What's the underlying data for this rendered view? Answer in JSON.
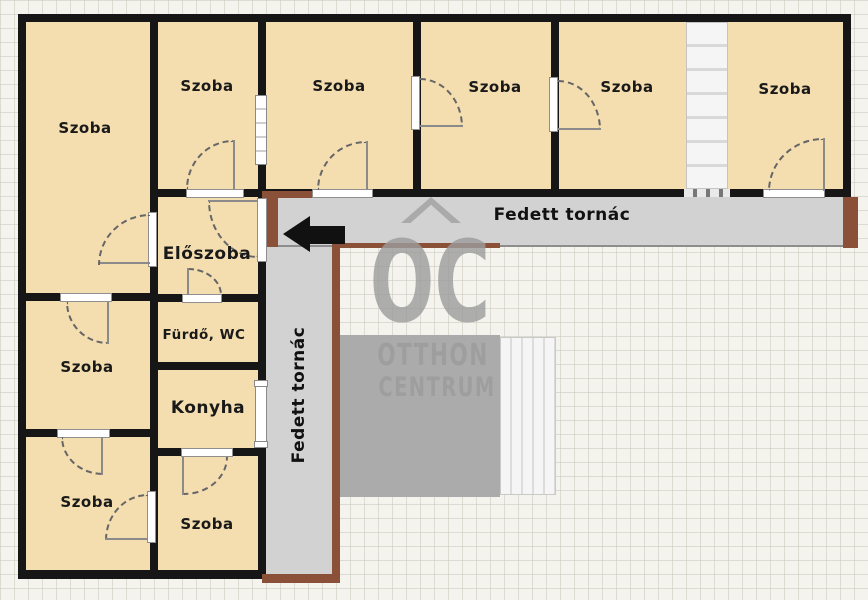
{
  "plan": {
    "rooms": [
      {
        "id": "szoba-top-left",
        "label": "Szoba"
      },
      {
        "id": "szoba-top-2",
        "label": "Szoba"
      },
      {
        "id": "szoba-top-3",
        "label": "Szoba"
      },
      {
        "id": "szoba-top-4",
        "label": "Szoba"
      },
      {
        "id": "szoba-top-5",
        "label": "Szoba"
      },
      {
        "id": "szoba-top-right",
        "label": "Szoba"
      },
      {
        "id": "eloszoba",
        "label": "Előszoba"
      },
      {
        "id": "furdo-wc",
        "label": "Fürdő, WC"
      },
      {
        "id": "konyha",
        "label": "Konyha"
      },
      {
        "id": "szoba-mid-left",
        "label": "Szoba"
      },
      {
        "id": "szoba-bottom-left",
        "label": "Szoba"
      },
      {
        "id": "szoba-bottom-center",
        "label": "Szoba"
      }
    ],
    "porches": {
      "horizontal_label": "Fedett tornác",
      "vertical_label": "Fedett tornác"
    },
    "watermark": {
      "logo": "OC",
      "line1": "OTTHON",
      "line2": "CENTRUM"
    },
    "colors": {
      "room_fill": "#f4deb0",
      "wall": "#161616",
      "porch": "#d2d2d2",
      "terrace": "#ababab",
      "wood": "#8a5138",
      "watermark": "#9c9c9c",
      "arrow": "#111111"
    }
  }
}
